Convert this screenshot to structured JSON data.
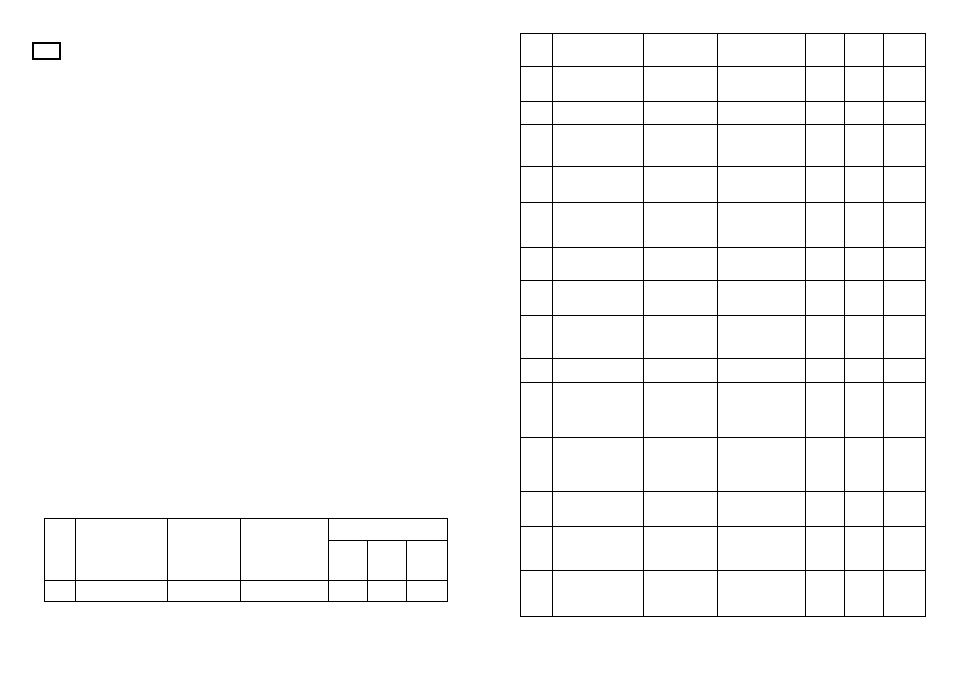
{
  "page": {
    "background_color": "#ffffff",
    "line_color": "#000000",
    "visible_text": ""
  },
  "corner_box": {
    "value": ""
  },
  "title_block": {
    "col_widths": [
      30,
      91,
      72,
      87,
      38,
      38,
      40
    ],
    "row_heights": [
      21,
      39,
      20
    ],
    "cells": [
      {
        "row": 1,
        "col": 1,
        "rowspan": 2,
        "colspan": 1,
        "name": "title-block-header-col1",
        "value": ""
      },
      {
        "row": 1,
        "col": 2,
        "rowspan": 2,
        "colspan": 1,
        "name": "title-block-header-col2",
        "value": ""
      },
      {
        "row": 1,
        "col": 3,
        "rowspan": 2,
        "colspan": 1,
        "name": "title-block-header-col3",
        "value": ""
      },
      {
        "row": 1,
        "col": 4,
        "rowspan": 2,
        "colspan": 1,
        "name": "title-block-header-col4",
        "value": ""
      },
      {
        "row": 1,
        "col": 5,
        "rowspan": 1,
        "colspan": 3,
        "name": "title-block-group-header",
        "value": ""
      },
      {
        "row": 2,
        "col": 5,
        "rowspan": 1,
        "colspan": 1,
        "name": "title-block-subheader-1",
        "value": ""
      },
      {
        "row": 2,
        "col": 6,
        "rowspan": 1,
        "colspan": 1,
        "name": "title-block-subheader-2",
        "value": ""
      },
      {
        "row": 2,
        "col": 7,
        "rowspan": 1,
        "colspan": 1,
        "name": "title-block-subheader-3",
        "value": ""
      },
      {
        "row": 3,
        "col": 1,
        "rowspan": 1,
        "colspan": 1,
        "name": "title-block-data-col1",
        "value": ""
      },
      {
        "row": 3,
        "col": 2,
        "rowspan": 1,
        "colspan": 1,
        "name": "title-block-data-col2",
        "value": ""
      },
      {
        "row": 3,
        "col": 3,
        "rowspan": 1,
        "colspan": 1,
        "name": "title-block-data-col3",
        "value": ""
      },
      {
        "row": 3,
        "col": 4,
        "rowspan": 1,
        "colspan": 1,
        "name": "title-block-data-col4",
        "value": ""
      },
      {
        "row": 3,
        "col": 5,
        "rowspan": 1,
        "colspan": 1,
        "name": "title-block-data-col5",
        "value": ""
      },
      {
        "row": 3,
        "col": 6,
        "rowspan": 1,
        "colspan": 1,
        "name": "title-block-data-col6",
        "value": ""
      },
      {
        "row": 3,
        "col": 7,
        "rowspan": 1,
        "colspan": 1,
        "name": "title-block-data-col7",
        "value": ""
      }
    ]
  },
  "parts_table": {
    "columns": 7,
    "rows": 15,
    "col_widths": [
      31,
      90,
      73,
      87,
      38,
      38,
      41
    ],
    "row_heights": [
      32,
      34,
      22,
      41,
      35,
      44,
      32,
      34,
      42,
      23,
      54,
      53,
      34,
      43,
      45
    ],
    "cell_value": ""
  }
}
